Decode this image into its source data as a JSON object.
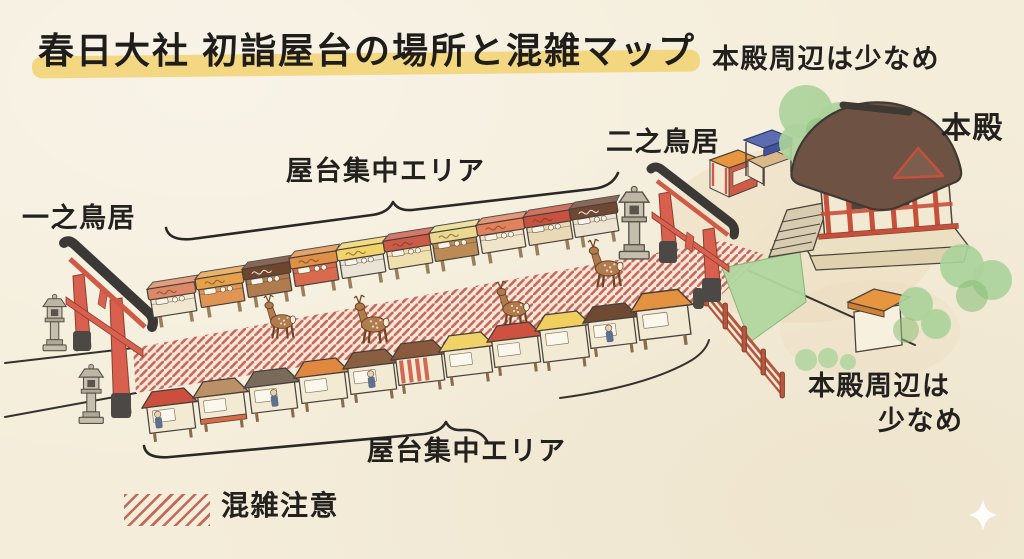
{
  "title": {
    "text": "春日大社 初詣屋台の場所と混雑マップ"
  },
  "labels": {
    "honden_note_top": "本殿周辺は少なめ",
    "ni_no_torii": "二之鳥居",
    "honden": "本殿",
    "yatai_area_top": "屋台集中エリア",
    "ichi_no_torii": "一之鳥居",
    "yatai_area_bottom": "屋台集中エリア",
    "honden_note_right_l1": "本殿周辺は",
    "honden_note_right_l2": "少なめ",
    "legend_label": "混雑注意"
  },
  "colors": {
    "background": "#f4edda",
    "ink": "#23211e",
    "title_highlight": "#f1cd60",
    "hatch_stripe": "#c4685a",
    "hatch_bg": "#f9e8da",
    "torii_red": "#d9604f",
    "torii_beam_dark": "#3c3836",
    "hall_roof_brown": "#6e5244",
    "hall_red": "#c5503c",
    "tree_green": "#abd29b",
    "grass_green": "#b2d79f",
    "fence_red": "#b5573f",
    "stone_gray": "#beb5a4",
    "deer_brown": "#b07c4e"
  },
  "illustration": {
    "stalls_top": [
      {
        "x": 148,
        "y": 283,
        "roof": "#dd8866",
        "body": "#f2e7cf"
      },
      {
        "x": 196,
        "y": 273,
        "roof": "#e6a24b",
        "body": "#e09555"
      },
      {
        "x": 243,
        "y": 263,
        "roof": "#6f452e",
        "body": "#b07b4f"
      },
      {
        "x": 290,
        "y": 252,
        "roof": "#e08f46",
        "body": "#d96a4d"
      },
      {
        "x": 337,
        "y": 244,
        "roof": "#f1d36a",
        "body": "#e9e4d6"
      },
      {
        "x": 384,
        "y": 235,
        "roof": "#cd5948",
        "body": "#f0e0b0"
      },
      {
        "x": 430,
        "y": 227,
        "roof": "#ead98f",
        "body": "#bb8a55"
      },
      {
        "x": 477,
        "y": 219,
        "roof": "#e2815c",
        "body": "#f0e4ca"
      },
      {
        "x": 524,
        "y": 211,
        "roof": "#c8513f",
        "body": "#ead9b6"
      },
      {
        "x": 570,
        "y": 203,
        "roof": "#6f4733",
        "body": "#ece4d0"
      }
    ],
    "stalls_bottom": [
      {
        "x": 143,
        "y": 393,
        "roof": "#cc4f3e",
        "person": 12
      },
      {
        "x": 194,
        "y": 383,
        "roof": "#bb9066",
        "base": "#d96a45"
      },
      {
        "x": 245,
        "y": 373,
        "roof": "#7a6a5c",
        "person": 26
      },
      {
        "x": 295,
        "y": 363,
        "roof": "#e0883f"
      },
      {
        "x": 344,
        "y": 354,
        "roof": "#8a5f41",
        "person": 24
      },
      {
        "x": 392,
        "y": 345,
        "roof": "#8a5a3e",
        "stripes": true
      },
      {
        "x": 440,
        "y": 337,
        "roof": "#f0d269"
      },
      {
        "x": 488,
        "y": 327,
        "roof": "#cf5140"
      },
      {
        "x": 536,
        "y": 316,
        "roof": "#f0cf5e",
        "tall": true
      },
      {
        "x": 584,
        "y": 308,
        "roof": "#6f4a33",
        "person": 22
      },
      {
        "x": 632,
        "y": 295,
        "roof": "#e3923f",
        "big": true
      }
    ],
    "deer": [
      {
        "x": 262,
        "y": 294,
        "s": 0.95
      },
      {
        "x": 352,
        "y": 294,
        "s": 1.05
      },
      {
        "x": 494,
        "y": 280,
        "s": 1.0
      },
      {
        "x": 586,
        "y": 238,
        "s": 1.05
      }
    ],
    "lanterns": [
      {
        "x": 42,
        "y": 294,
        "s": 1.05
      },
      {
        "x": 78,
        "y": 364,
        "s": 1.1
      },
      {
        "x": 618,
        "y": 186,
        "s": 1.35
      }
    ]
  }
}
